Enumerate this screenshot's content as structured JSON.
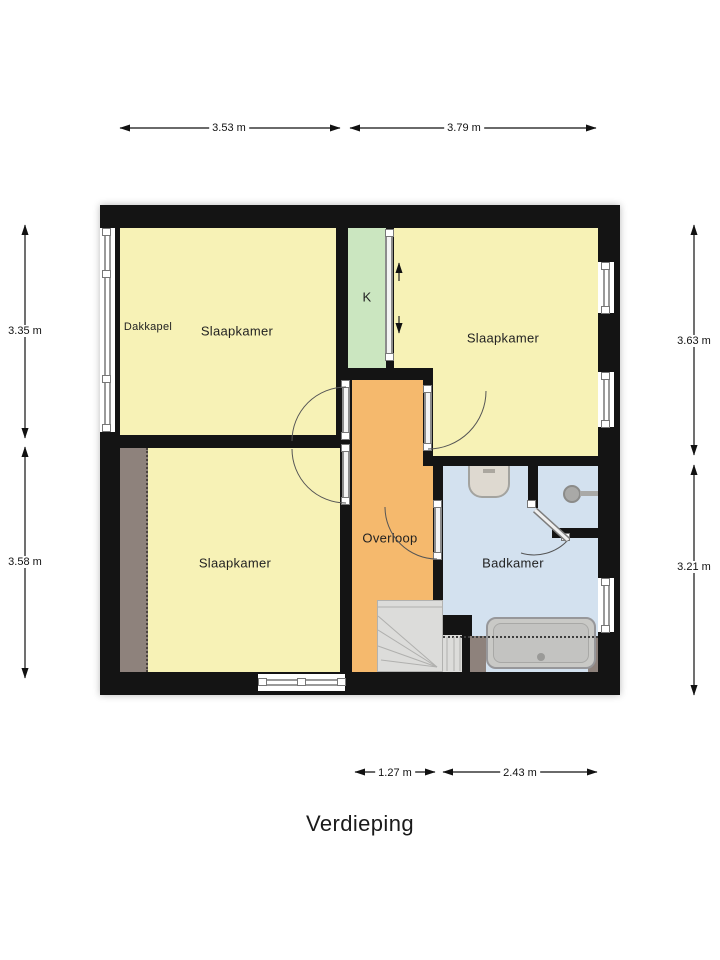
{
  "title": "Verdieping",
  "rooms": {
    "bedroom_top_left": {
      "label": "Slaapkamer",
      "annex": "Dakkapel"
    },
    "bedroom_right": {
      "label": "Slaapkamer"
    },
    "bedroom_bottom_left": {
      "label": "Slaapkamer"
    },
    "closet": {
      "label": "K"
    },
    "landing": {
      "label": "Overloop"
    },
    "bathroom": {
      "label": "Badkamer"
    }
  },
  "dimensions": {
    "top": [
      "3.53 m",
      "3.79 m"
    ],
    "left": [
      "3.35 m",
      "3.58 m"
    ],
    "right": [
      "3.63 m",
      "3.21 m"
    ],
    "bottom": [
      "1.27 m",
      "2.43 m"
    ]
  },
  "colors": {
    "wall": "#141414",
    "bedroom": "#F7F2B6",
    "closet": "#CBE6C0",
    "landing": "#F5B96D",
    "bathroom": "#D3E1EF",
    "slope": "#8E827C",
    "stairs": "#DCDCDA",
    "fixture": "#C9C9C6"
  }
}
